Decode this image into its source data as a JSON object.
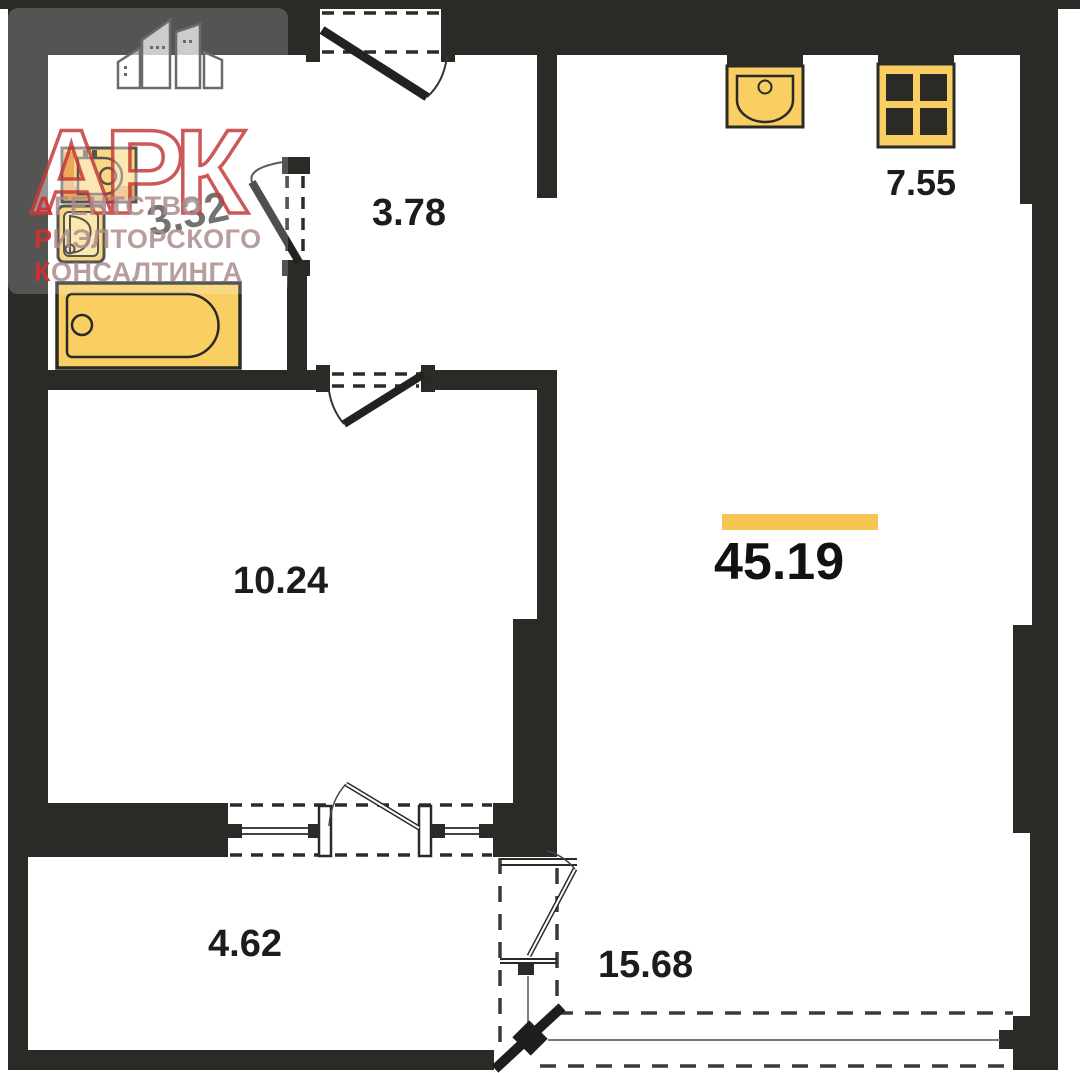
{
  "plan_title": "apartment floor plan",
  "rooms": {
    "bathroom": {
      "name": "bathroom",
      "area": "3.32"
    },
    "hallway": {
      "name": "hallway",
      "area": "3.78"
    },
    "kitchen": {
      "name": "kitchen-zone",
      "area": "7.55"
    },
    "room": {
      "name": "room",
      "area": "10.24"
    },
    "total": {
      "name": "total-living-space",
      "area": "45.19",
      "highlighted": true
    },
    "balcony": {
      "name": "balcony",
      "area": "4.62"
    },
    "terrace": {
      "name": "terrace",
      "area": "15.68"
    }
  },
  "logo": {
    "acronym": "АРК",
    "lines": [
      {
        "first": "А",
        "rest": "ГЕНТСТВО"
      },
      {
        "first": "Р",
        "rest": "ИЭЛТОРСКОГО"
      },
      {
        "first": "К",
        "rest": "ОНСАЛТИНГА"
      }
    ]
  },
  "fixtures": [
    "washbasin",
    "toilet",
    "bathtub",
    "kitchen-sink",
    "stove"
  ],
  "colors": {
    "wall": "#2a2a27",
    "fixture_fill": "#f9ce63",
    "fixture_accent": "#e79335",
    "highlight_bar": "#f6c453",
    "logo_red": "#c43c3c"
  }
}
